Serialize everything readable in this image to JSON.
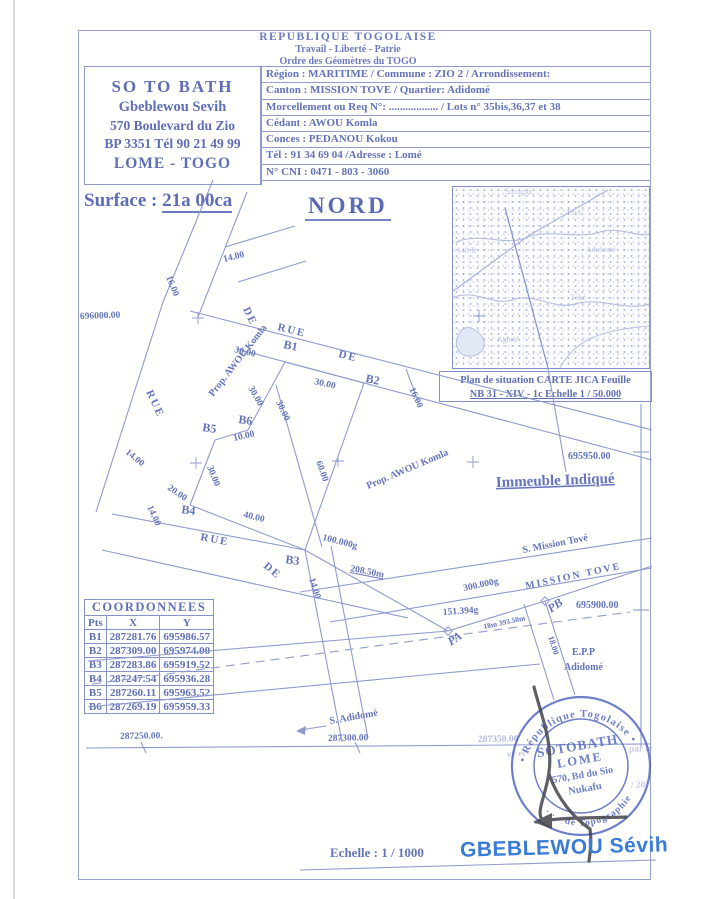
{
  "colors": {
    "ink": "#6474bc",
    "ink_dark": "#5a6ab4",
    "line": "#8f9bce",
    "accent_name": "#3a7cd8",
    "stamp": "#4d63bd",
    "signature": "#42434b"
  },
  "header": {
    "line1": "REPUBLIQUE  TOGOLAISE",
    "line2": "Travail - Liberté - Patrie",
    "line3": "Ordre des Géomètres du TOGO"
  },
  "letterhead": {
    "line1": "SO  TO  BATH",
    "line2": "Gbeblewou Sevih",
    "line3": "570 Boulevard du Zio",
    "line4": "BP 3351 Tél 90 21 49 99",
    "line5": "LOME - TOGO"
  },
  "info_rows": [
    "Région : MARITIME / Commune : ZIO 2  / Arrondissement:",
    "Canton : MISSION TOVE  /  Quartier: Adidomé",
    "Morcellement ou Req N°: .................. / Lots  n° 35bis,36,37 et 38",
    "Cédant : AWOU  Komla",
    "Conces : PEDANOU  Kokou",
    "Tél : 91  34  69  04    /Adresse : Lomé",
    "N° CNI : 0471 - 803 - 3060"
  ],
  "surface": {
    "label": "Surface : ",
    "value": "21a 00ca"
  },
  "north_label": "NORD",
  "map": {
    "caption1": "Plan de situation CARTE JICA Feuille",
    "caption2": "NB 31 - XIV - 1c Echelle 1 / 50.000",
    "faint_labels": [
      {
        "t": "Sovagan",
        "x": 505,
        "y": 194
      },
      {
        "t": "Tové",
        "x": 566,
        "y": 215
      },
      {
        "t": "148 B",
        "x": 457,
        "y": 253
      },
      {
        "t": "Adidomé",
        "x": 586,
        "y": 252
      },
      {
        "t": "Téké",
        "x": 570,
        "y": 300
      },
      {
        "t": "Agbné",
        "x": 497,
        "y": 342
      }
    ]
  },
  "plan": {
    "labels": [
      {
        "t": "14.00",
        "x": 224,
        "y": 262,
        "r": -14,
        "s": 9.5
      },
      {
        "t": "16.00",
        "x": 166,
        "y": 277,
        "r": 68,
        "s": 9.5
      },
      {
        "t": "696000.00",
        "x": 80,
        "y": 319,
        "r": -2,
        "s": 9.5
      },
      {
        "t": "RUE",
        "x": 277,
        "y": 330,
        "r": 14,
        "s": 11,
        "c": "sp"
      },
      {
        "t": "DE",
        "x": 338,
        "y": 357,
        "r": 14,
        "s": 11,
        "c": "sp"
      },
      {
        "t": "RUE",
        "x": 146,
        "y": 392,
        "r": 65,
        "s": 11,
        "c": "sp"
      },
      {
        "t": "DE",
        "x": 243,
        "y": 309,
        "r": 65,
        "s": 11,
        "c": "sp"
      },
      {
        "t": "B1",
        "x": 283,
        "y": 348,
        "r": 12,
        "s": 12
      },
      {
        "t": "B2",
        "x": 365,
        "y": 382,
        "r": 12,
        "s": 12
      },
      {
        "t": "30.00",
        "x": 234,
        "y": 352,
        "r": 13,
        "s": 9.5
      },
      {
        "t": "30.00",
        "x": 314,
        "y": 384,
        "r": 13,
        "s": 9.5
      },
      {
        "t": "30.00",
        "x": 248,
        "y": 388,
        "r": 60,
        "s": 9.5
      },
      {
        "t": "30.00",
        "x": 276,
        "y": 402,
        "r": 65,
        "s": 9.5
      },
      {
        "t": "60.00",
        "x": 316,
        "y": 462,
        "r": 70,
        "s": 9.5
      },
      {
        "t": "16.00",
        "x": 409,
        "y": 389,
        "r": 65,
        "s": 9.5
      },
      {
        "t": "B5",
        "x": 202,
        "y": 431,
        "r": 8,
        "s": 12
      },
      {
        "t": "B6",
        "x": 238,
        "y": 423,
        "r": 8,
        "s": 12
      },
      {
        "t": "10.00",
        "x": 234,
        "y": 441,
        "r": -13,
        "s": 9.5
      },
      {
        "t": "30.00",
        "x": 207,
        "y": 467,
        "r": 68,
        "s": 9.5
      },
      {
        "t": "Prop. AWOU  Komla",
        "x": 213,
        "y": 397,
        "r": -52,
        "s": 10
      },
      {
        "t": "Prop. AWOU  Komla",
        "x": 368,
        "y": 489,
        "r": -23,
        "s": 10
      },
      {
        "t": "B4",
        "x": 181,
        "y": 513,
        "r": 8,
        "s": 12
      },
      {
        "t": "14.00",
        "x": 125,
        "y": 453,
        "r": 40,
        "s": 9.5
      },
      {
        "t": "14.00",
        "x": 147,
        "y": 507,
        "r": 65,
        "s": 9.5
      },
      {
        "t": "20.00",
        "x": 167,
        "y": 489,
        "r": 35,
        "s": 9.5
      },
      {
        "t": "40.00",
        "x": 243,
        "y": 517,
        "r": 14,
        "s": 9.5
      },
      {
        "t": "100.000g",
        "x": 322,
        "y": 540,
        "r": 14,
        "s": 9.5
      },
      {
        "t": "B3",
        "x": 285,
        "y": 563,
        "r": 8,
        "s": 12
      },
      {
        "t": "14.00",
        "x": 309,
        "y": 579,
        "r": 72,
        "s": 9.5
      },
      {
        "t": "208.50m",
        "x": 350,
        "y": 571,
        "r": 11,
        "s": 9.5,
        "c": "u"
      },
      {
        "t": "RUE",
        "x": 200,
        "y": 540,
        "r": 11,
        "s": 11,
        "c": "sp"
      },
      {
        "t": "DE",
        "x": 263,
        "y": 567,
        "r": 40,
        "s": 11,
        "c": "sp"
      },
      {
        "t": "S. Mission Tové",
        "x": 523,
        "y": 553,
        "r": -11,
        "s": 10
      },
      {
        "t": "300.000g",
        "x": 464,
        "y": 591,
        "r": -12,
        "s": 9.5
      },
      {
        "t": "MISSION  TOVE",
        "x": 526,
        "y": 589,
        "r": -12,
        "s": 10,
        "c": "sp"
      },
      {
        "t": "PB",
        "x": 551,
        "y": 613,
        "r": -35,
        "s": 12,
        "c": "bi"
      },
      {
        "t": "PA",
        "x": 451,
        "y": 646,
        "r": -35,
        "s": 12,
        "c": "bi"
      },
      {
        "t": "151.394g",
        "x": 443,
        "y": 615,
        "r": -4,
        "s": 9.5
      },
      {
        "t": "18m 393.50m",
        "x": 484,
        "y": 629,
        "r": -12,
        "s": 7.5
      },
      {
        "t": "18.00",
        "x": 548,
        "y": 637,
        "r": 72,
        "s": 8.5
      },
      {
        "t": "695900.00",
        "x": 576,
        "y": 608,
        "r": 0,
        "s": 10
      },
      {
        "t": "695950.00",
        "x": 568,
        "y": 459,
        "r": 0,
        "s": 10
      },
      {
        "t": "E.P.P",
        "x": 572,
        "y": 655,
        "r": 0,
        "s": 10
      },
      {
        "t": "Adidomé",
        "x": 564,
        "y": 670,
        "r": 0,
        "s": 10
      },
      {
        "t": "S. Adidomé",
        "x": 330,
        "y": 724,
        "r": -10,
        "s": 10
      },
      {
        "t": "287250.00.",
        "x": 120,
        "y": 739,
        "r": -1,
        "s": 9.5
      },
      {
        "t": "287300.00",
        "x": 328,
        "y": 741,
        "r": -1,
        "s": 9.5
      },
      {
        "t": "287350.00",
        "x": 478,
        "y": 742,
        "r": -1,
        "s": 9.5,
        "c": "faint"
      },
      {
        "t": "Immeuble Indiqué",
        "x": 496,
        "y": 487,
        "r": -2,
        "s": 15,
        "c": "u"
      }
    ],
    "lines": [
      [
        86,
        748,
        650,
        744
      ],
      [
        641,
        404,
        641,
        747
      ],
      [
        633,
        452,
        649,
        452
      ],
      [
        633,
        610,
        649,
        610
      ],
      [
        141,
        742,
        146,
        753
      ],
      [
        355,
        742,
        360,
        753
      ],
      [
        190,
        311,
        652,
        430
      ],
      [
        237,
        349,
        652,
        460
      ],
      [
        213,
        180,
        163,
        302
      ],
      [
        163,
        302,
        96,
        512
      ],
      [
        247,
        192,
        198,
        317
      ],
      [
        225,
        247,
        295,
        226
      ],
      [
        238,
        282,
        306,
        261
      ],
      [
        285,
        362,
        364,
        383
      ],
      [
        364,
        383,
        305,
        550
      ],
      [
        305,
        550,
        190,
        505
      ],
      [
        190,
        505,
        215,
        440
      ],
      [
        215,
        440,
        248,
        430
      ],
      [
        248,
        430,
        285,
        362
      ],
      [
        276,
        385,
        322,
        547
      ],
      [
        112,
        514,
        305,
        550
      ],
      [
        102,
        550,
        408,
        618
      ],
      [
        305,
        550,
        342,
        742
      ],
      [
        331,
        546,
        368,
        738
      ],
      [
        88,
        661,
        448,
        631
      ],
      [
        448,
        631,
        545,
        601
      ],
      [
        545,
        601,
        652,
        566
      ],
      [
        88,
        707,
        540,
        664
      ],
      [
        300,
        592,
        652,
        538
      ],
      [
        330,
        622,
        652,
        568
      ],
      [
        545,
        601,
        575,
        695
      ],
      [
        524,
        604,
        554,
        700
      ],
      [
        305,
        550,
        448,
        631
      ],
      [
        406,
        369,
        418,
        401
      ],
      [
        548,
        369,
        566,
        472
      ],
      [
        300,
        730,
        326,
        726
      ],
      [
        300,
        870,
        656,
        860
      ]
    ],
    "dashed": [
      [
        92,
        684,
        630,
        612
      ]
    ],
    "crosses": [
      [
        198,
        318
      ],
      [
        196,
        463
      ],
      [
        338,
        461
      ],
      [
        473,
        462
      ],
      [
        479,
        316
      ]
    ],
    "points": [
      [
        448,
        631
      ],
      [
        545,
        601
      ]
    ]
  },
  "coords_table": {
    "title": "COORDONNEES",
    "headers": [
      "Pts",
      "X",
      "Y"
    ],
    "rows": [
      [
        "B1",
        "287281.76",
        "695986.57"
      ],
      [
        "B2",
        "287309.00",
        "695974.00"
      ],
      [
        "B3",
        "287283.86",
        "695919.52"
      ],
      [
        "B4",
        "287247.54",
        "695936.28"
      ],
      [
        "B5",
        "287260.11",
        "695963.52"
      ],
      [
        "B6",
        "287269.19",
        "695959.33"
      ]
    ]
  },
  "footer": {
    "scale_label": "Echelle : 1 / 1000",
    "surveyor": "GBEBLEWOU Sévih"
  },
  "stamp": {
    "ring_top": "• République  Togolaise •",
    "ring_bottom": "· · ·  de Topographie",
    "line1": "SOTOBATH",
    "line2": "LOME",
    "line3": "570, Bd du Sio",
    "line4": "Nukafu",
    "fragments": [
      {
        "t": "vé et",
        "x": 507,
        "y": 757
      },
      {
        "t": "par le",
        "x": 629,
        "y": 752
      },
      {
        "t": "/ 20",
        "x": 631,
        "y": 788
      }
    ]
  }
}
